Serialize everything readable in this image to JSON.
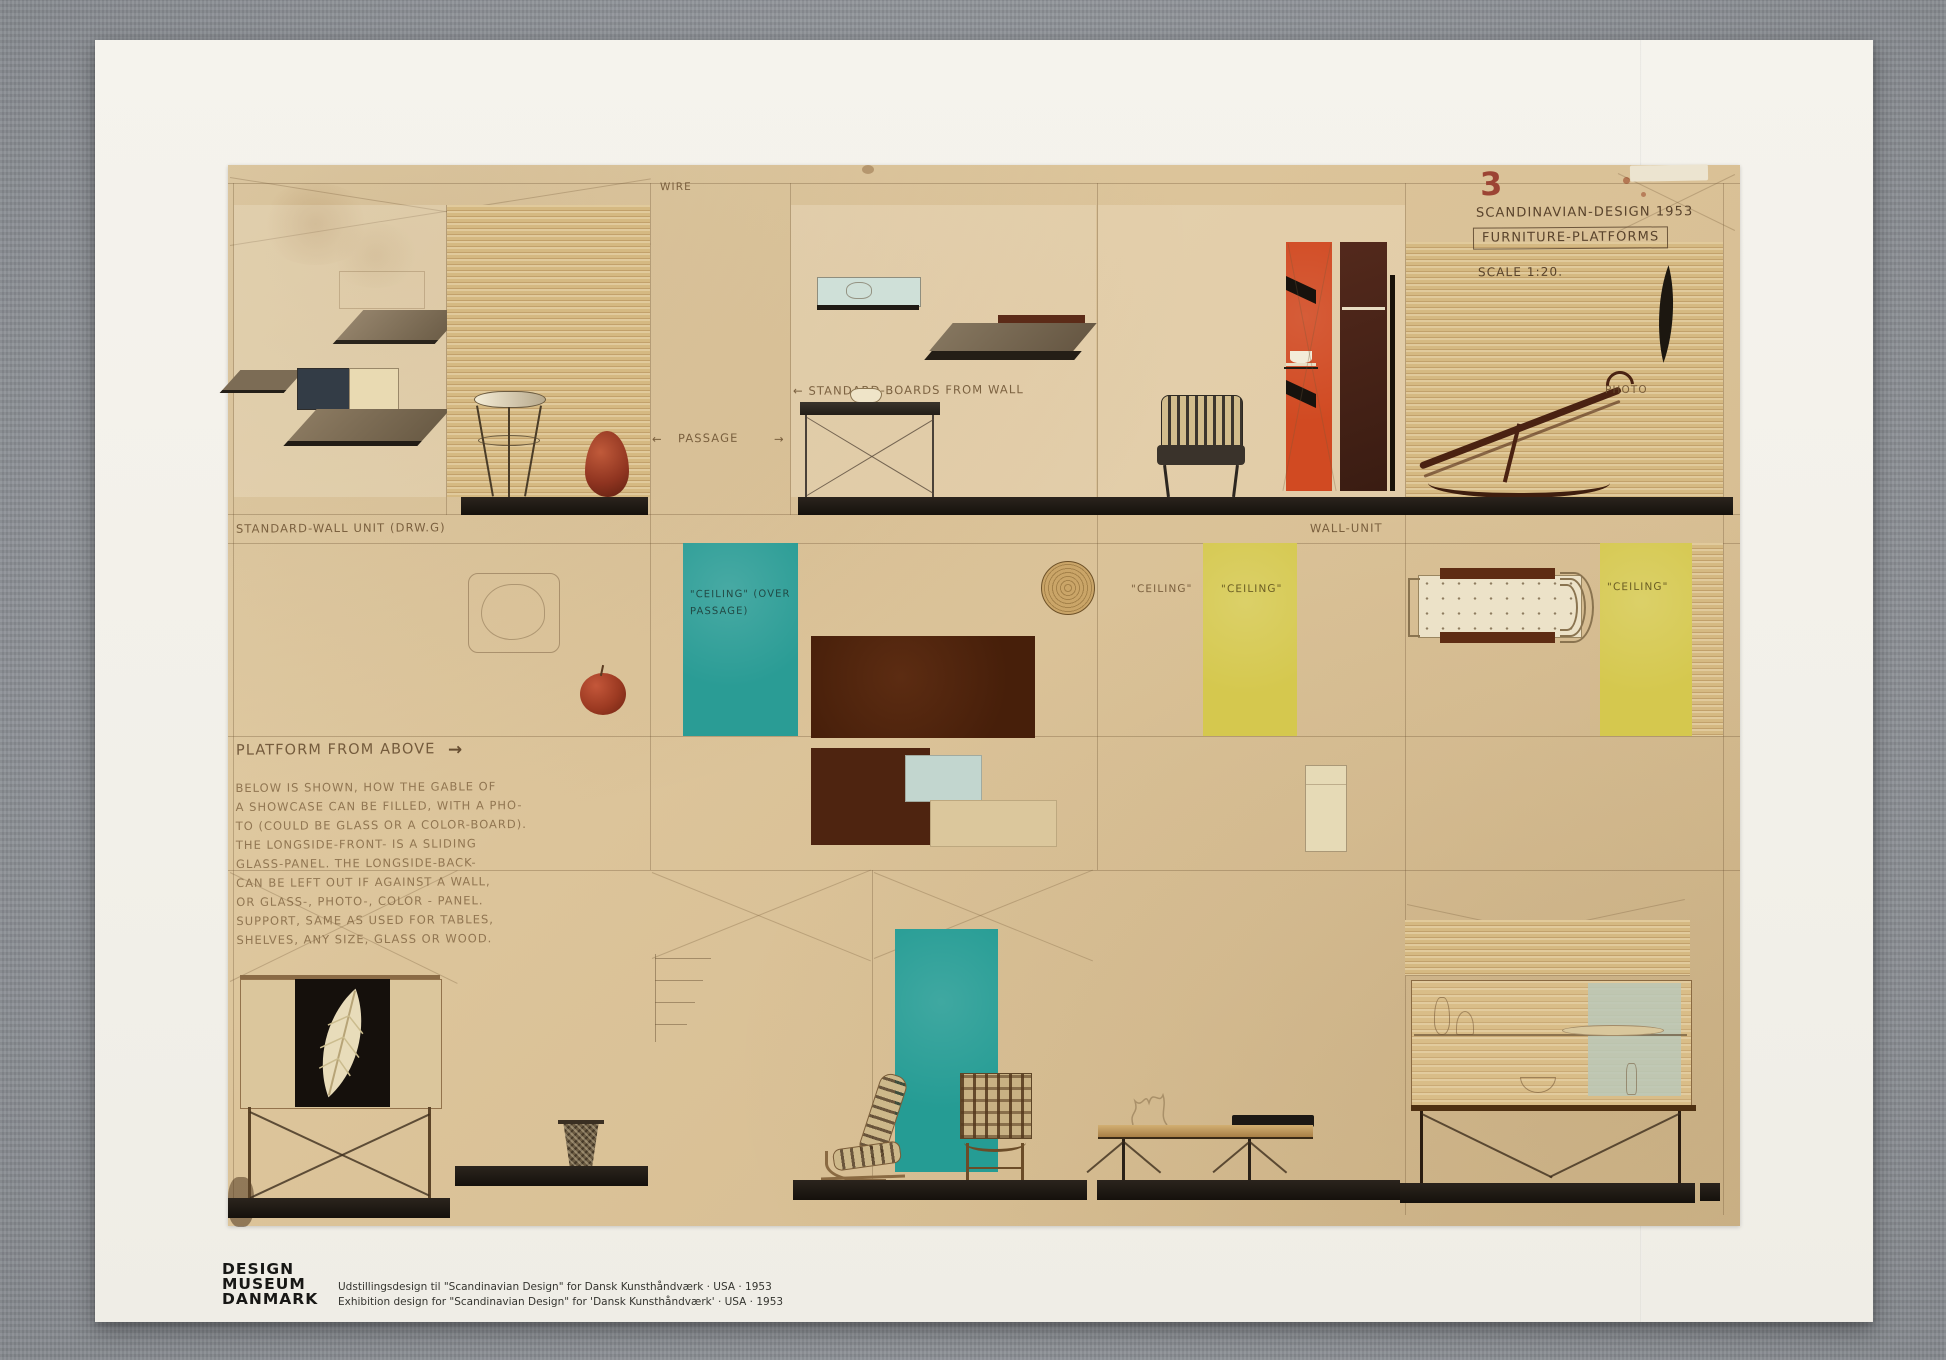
{
  "scene": {
    "backdrop": "gray-linen-fabric",
    "background_color": "#969aa0",
    "poster_color": "#f3f1ea",
    "paper_color": "#d9c296"
  },
  "title_block": {
    "plate_number": "3",
    "line1": "SCANDINAVIAN-DESIGN 1953",
    "line2": "FURNITURE-PLATFORMS",
    "scale": "SCALE 1:20."
  },
  "labels": {
    "wire": "WIRE",
    "passage": "PASSAGE",
    "arrow_left": "←",
    "arrow_right": "→",
    "standard_boards": "← STANDARD-BOARDS FROM WALL",
    "standard_wall_unit": "STANDARD-WALL UNIT (DRW.G)",
    "wall_unit": "WALL-UNIT",
    "photo": "PHOTO",
    "ceiling_mid": "\"CEILING\"",
    "ceiling_yellow_1": "\"CEILING\"",
    "ceiling_yellow_2": "\"CEILING\"",
    "ceiling_teal_line1": "\"CEILING\" (OVER",
    "ceiling_teal_line2": "PASSAGE)",
    "platform_from_above": "PLATFORM FROM ABOVE",
    "pfa_arrow": "→"
  },
  "note_lines": [
    "BELOW IS SHOWN, HOW THE GABLE OF",
    "A SHOWCASE CAN BE FILLED, WITH A PHO-",
    "TO (COULD BE GLASS OR A COLOR-BOARD).",
    "THE LONGSIDE-FRONT- IS A SLIDING",
    "GLASS-PANEL.  THE LONGSIDE-BACK-",
    "CAN BE LEFT OUT IF AGAINST A WALL,",
    "OR GLASS-, PHOTO-, COLOR - PANEL.",
    "SUPPORT, SAME AS USED FOR TABLES,",
    "SHELVES, ANY SIZE, GLASS OR WOOD."
  ],
  "footer": {
    "logo_lines": [
      "DESIGN",
      "MUSEUM",
      "DANMARK"
    ],
    "caption_lines": [
      "Udstillingsdesign til \"Scandinavian Design\" for Dansk Kunsthåndværk  ·  USA  ·  1953",
      "Exhibition design for \"Scandinavian Design\" for 'Dansk Kunsthåndværk'  ·  USA  ·  1953"
    ]
  },
  "palette": {
    "teal": "#2a9c95",
    "orange": "#d14a22",
    "yellow": "#d5c84e",
    "rug_brown": "#4e240f",
    "vase_red": "#9c3a22",
    "platform_black": "#211c16",
    "wood_tan": "#d5b982",
    "pale_blue": "#c2d6cf",
    "plate_number_red": "#9c4434"
  }
}
